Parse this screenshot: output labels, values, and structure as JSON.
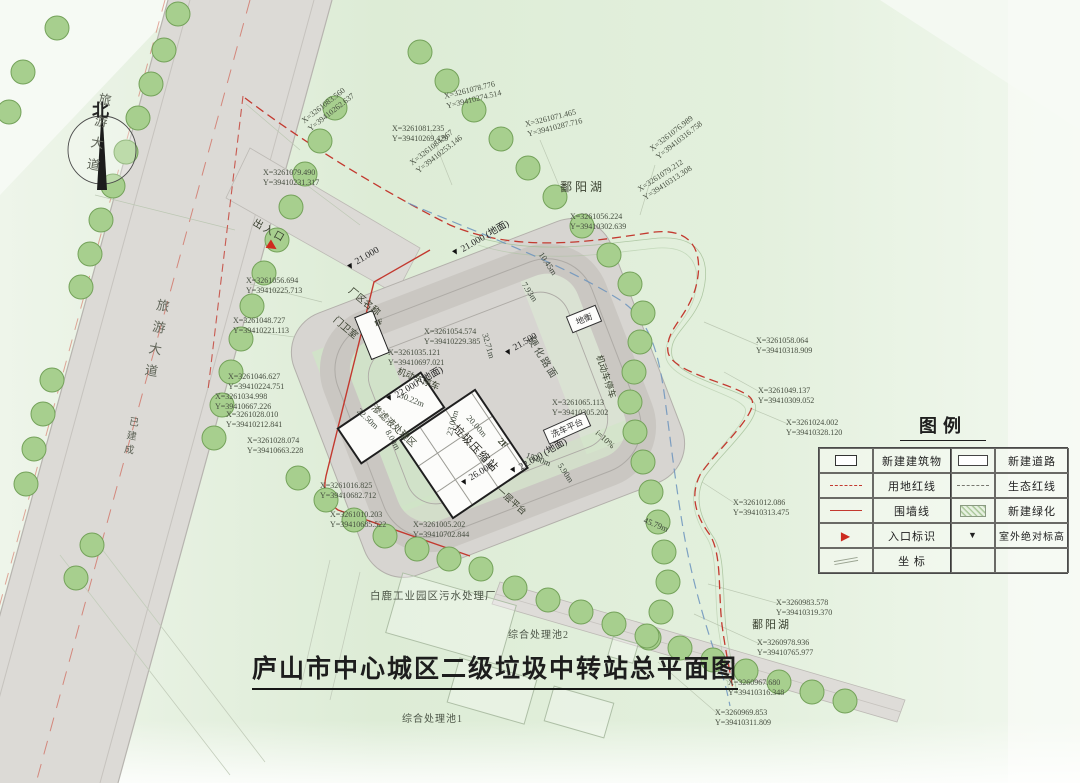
{
  "title": "庐山市中心城区二级垃圾中转站总平面图",
  "north": {
    "label": "北"
  },
  "icons": {
    "elevation": "▼",
    "entrance": "▶"
  },
  "legend": {
    "title": "图例",
    "rows": [
      {
        "left_label": "新建建筑物",
        "right_label": "新建道路"
      },
      {
        "left_label": "用地红线",
        "right_label": "生态红线"
      },
      {
        "left_label": "围墙线",
        "right_label": "新建绿化"
      },
      {
        "left_label": "入口标识",
        "right_label": "室外绝对标高"
      },
      {
        "left_label": "坐  标",
        "right_label": ""
      }
    ]
  },
  "labels": {
    "poyang_lake_top": "鄱阳湖",
    "poyang_lake_bottom": "鄱阳湖",
    "tourist_road_top": "旅游大道",
    "tourist_road_mid": "旅游大道",
    "built_note": "已建成",
    "entrance": "出入口",
    "plant_name_sign": "厂区名称",
    "gatehouse": "门卫室",
    "gatehouse_floor": "1F",
    "weighbridge": "地衡",
    "pavement": "硬化路面",
    "parking_left": "机动车停车",
    "parking_right": "机动车停车",
    "car_wash": "洗车平台",
    "platform_first": "一层平台",
    "slope": "i=10%",
    "compression_station": "垃圾压缩站",
    "station_floor": "2F",
    "leachate_area": "渗滤液处理区",
    "pool2": "综合处理池2",
    "pool1": "综合处理池1",
    "sewage_plant": "白鹿工业园区污水处理厂"
  },
  "coordinates": [
    {
      "x": "X=3261079.490",
      "y": "Y=39410231.317"
    },
    {
      "x": "X=3261083.560",
      "y": "Y=39410262.637"
    },
    {
      "x": "X=3261081.235",
      "y": "Y=39410269.429"
    },
    {
      "x": "X=3261084.967",
      "y": "Y=39410253.146"
    },
    {
      "x": "X=3261078.776",
      "y": "Y=39410274.514"
    },
    {
      "x": "X=3261071.465",
      "y": "Y=39410287.716"
    },
    {
      "x": "X=3261076.989",
      "y": "Y=39410316.758"
    },
    {
      "x": "X=3261079.212",
      "y": "Y=39410313.308"
    },
    {
      "x": "X=3261056.224",
      "y": "Y=39410302.639"
    },
    {
      "x": "X=3261056.694",
      "y": "Y=39410225.713"
    },
    {
      "x": "X=3261048.727",
      "y": "Y=39410221.113"
    },
    {
      "x": "X=3261054.574",
      "y": "Y=39410229.385"
    },
    {
      "x": "X=3261035.121",
      "y": "Y=39410697.021"
    },
    {
      "x": "X=3261046.627",
      "y": "Y=39410224.751"
    },
    {
      "x": "X=3261034.998",
      "y": "Y=39410667.226"
    },
    {
      "x": "X=3261028.010",
      "y": "Y=39410212.841"
    },
    {
      "x": "X=3261028.074",
      "y": "Y=39410663.228"
    },
    {
      "x": "X=3261065.113",
      "y": "Y=39410305.202"
    },
    {
      "x": "X=3261058.064",
      "y": "Y=39410318.909"
    },
    {
      "x": "X=3261049.137",
      "y": "Y=39410309.052"
    },
    {
      "x": "X=3261024.002",
      "y": "Y=39410328.120"
    },
    {
      "x": "X=3261012.086",
      "y": "Y=39410313.475"
    },
    {
      "x": "X=3261016.825",
      "y": "Y=39410682.712"
    },
    {
      "x": "X=3261010.203",
      "y": "Y=39410685.522"
    },
    {
      "x": "X=3261005.202",
      "y": "Y=39410702.844"
    },
    {
      "x": "X=3260983.578",
      "y": "Y=39410319.370"
    },
    {
      "x": "X=3260978.936",
      "y": "Y=39410765.977"
    },
    {
      "x": "X=3260967.680",
      "y": "Y=39410316.348"
    },
    {
      "x": "X=3260969.853",
      "y": "Y=39410311.809"
    }
  ],
  "elevations": [
    {
      "value": "21.000"
    },
    {
      "value": "21.000 (地面)"
    },
    {
      "value": "21.500"
    },
    {
      "value": "22.000 (地面)"
    },
    {
      "value": "22.000 (地面)"
    },
    {
      "value": "26.000"
    }
  ],
  "dimensions": [
    {
      "value": "7.93m"
    },
    {
      "value": "10.45m"
    },
    {
      "value": "32.71m"
    },
    {
      "value": "30.22m"
    },
    {
      "value": "22.50m"
    },
    {
      "value": "8.00m"
    },
    {
      "value": "20.00m"
    },
    {
      "value": "23.00m"
    },
    {
      "value": "15.00m"
    },
    {
      "value": "5.90m"
    },
    {
      "value": "45.79m"
    }
  ],
  "colors": {
    "redline": "#c3392f",
    "ecoline": "#77776f",
    "wall": "#c3392f",
    "tree_fill": "#a7cf8e",
    "tree_stroke": "#74a25a",
    "road_fill": "#dcdad6",
    "plot_fill": "#d7d5d1",
    "eco_blue": "#6b93bd"
  }
}
